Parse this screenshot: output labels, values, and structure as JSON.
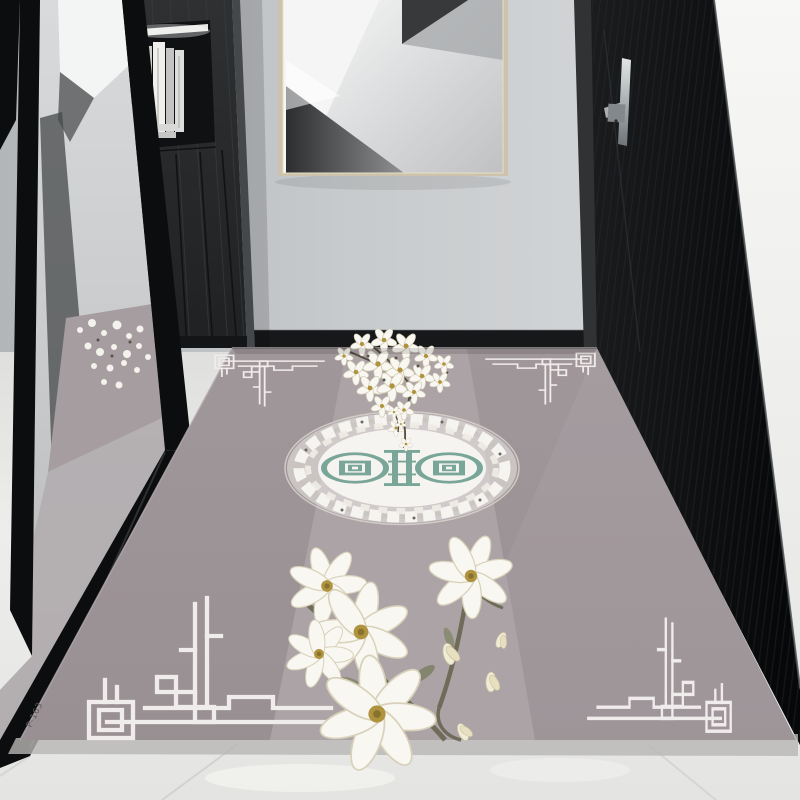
{
  "scene": {
    "kind": "entryway-interior-photo",
    "objects": [
      "leaning-wall-mirror",
      "dark-storage-cabinet",
      "abstract-framed-artwork",
      "gray-back-wall",
      "black-entry-door",
      "door-handle",
      "white-side-wall",
      "marble-tile-floor",
      "chinese-style-area-rug"
    ]
  },
  "rug": {
    "product_code": "P-163",
    "motifs": [
      "corner-fret-ornament",
      "floral-medallion",
      "magnolia-branch",
      "blossom-cluster"
    ]
  },
  "palette": {
    "wall": "#c6c9cb",
    "wall_right": "#f5f5f3",
    "baseboard": "#17181a",
    "floor": "#e9e9e7",
    "floor_seam": "#d2d2d0",
    "door": "#131517",
    "door_frame": "#303234",
    "door_edge": "#4a4e51",
    "handle": "#c0c5c7",
    "cabinet": "#282a2c",
    "cabinet_side": "#45484b",
    "niche": "#101113",
    "mirror_frame": "#0c0d0f",
    "glass": "#ccced0",
    "art_frame": "#cdc3ac",
    "rug_base": "#9c9396",
    "rug_center": "#aca3a6",
    "ornament": "#f1ecec",
    "medallion_ring": "#f6f4f0",
    "medallion_motif": "#79a699",
    "flower": "#f9f7f1",
    "flower_center": "#b0933f",
    "branch": "#6e6c59",
    "leaf": "#878970"
  }
}
